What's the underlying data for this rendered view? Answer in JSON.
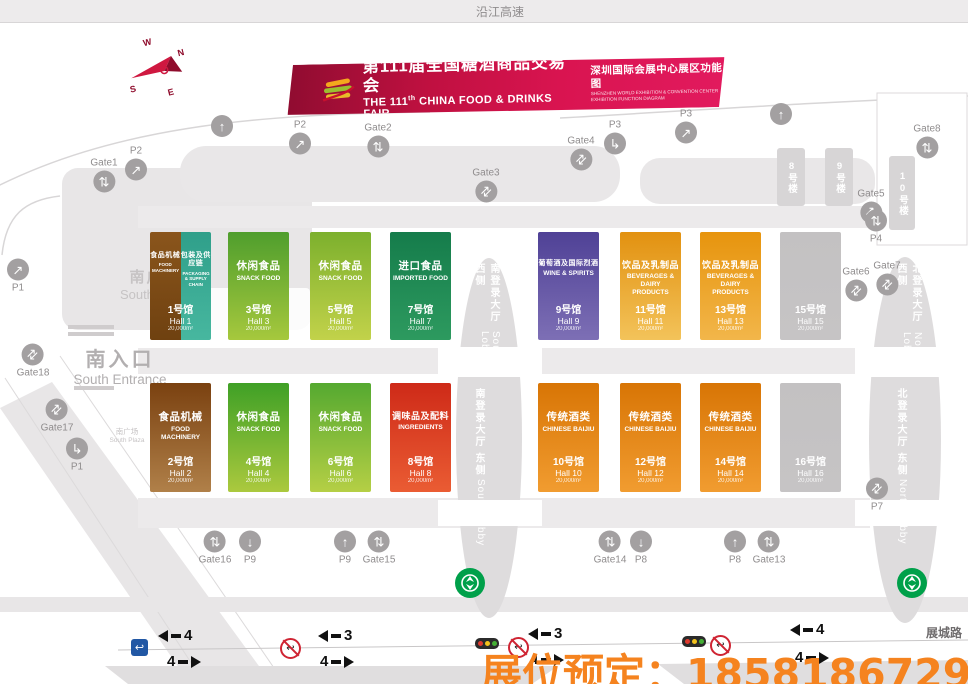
{
  "top_road": {
    "label": "沿江高速"
  },
  "bottom_road": {
    "label": "展城路"
  },
  "compass": {
    "n": "N",
    "e": "E",
    "s": "S",
    "w": "W"
  },
  "banner": {
    "title_zh": "第111届全国糖酒商品交易会",
    "en_pre": "THE 111",
    "en_sup": "th",
    "en_rest": " CHINA FOOD & DRINKS FAIR",
    "sub_zh": "深圳国际会展中心展区功能图",
    "sub_en1": "SHENZHEN WORLD EXHIBITION & CONVENTION CENTER",
    "sub_en2": "EXHIBITION FUNCTION DIAGRAM"
  },
  "places": {
    "south_plaza_zh": "南广场",
    "south_plaza_en": "South Plaza",
    "south_entrance_zh": "南入口",
    "south_entrance_en": "South Entrance",
    "south_plaza_small_zh": "南广场",
    "south_plaza_small_en": "South Plaza"
  },
  "lobbies": [
    {
      "zh": "南登录大厅 西侧",
      "en": "South Lobby",
      "x": 471,
      "y": 263,
      "h": 118
    },
    {
      "zh": "南登录大厅 东侧",
      "en": "South Lobby",
      "x": 471,
      "y": 388,
      "h": 160
    },
    {
      "zh": "北登录大厅 西侧",
      "en": "North Lobby",
      "x": 893,
      "y": 263,
      "h": 118
    },
    {
      "zh": "北登录大厅 东侧",
      "en": "North Lobby",
      "x": 893,
      "y": 388,
      "h": 160
    }
  ],
  "buildings": [
    {
      "label": "8号楼",
      "x": 777,
      "y": 148,
      "w": 28,
      "h": 58
    },
    {
      "label": "9号楼",
      "x": 825,
      "y": 148,
      "w": 28,
      "h": 58
    },
    {
      "label": "10号楼",
      "x": 889,
      "y": 156,
      "w": 26,
      "h": 74
    }
  ],
  "halls_top": [
    {
      "no": "1",
      "split": true,
      "left": {
        "zh": "食品机械",
        "en": "FOOD MACHINERY",
        "g": [
          "#8a551c",
          "#6f4110"
        ]
      },
      "right": {
        "zh": "包装及供应链",
        "en": "PACKAGING & SUPPLY CHAIN",
        "g": [
          "#2f9f8a",
          "#47b79f"
        ]
      },
      "name_zh": "1号馆",
      "name_en": "Hall 1",
      "area": "20,000m²"
    },
    {
      "no": "3",
      "zh": "休闲食品",
      "en": "SNACK FOOD",
      "g": [
        "#4f9e2d",
        "#a6c83d"
      ],
      "name_zh": "3号馆",
      "name_en": "Hall 3",
      "area": "20,000m²"
    },
    {
      "no": "5",
      "zh": "休闲食品",
      "en": "SNACK FOOD",
      "g": [
        "#7cb02d",
        "#c2d24a"
      ],
      "name_zh": "5号馆",
      "name_en": "Hall 5",
      "area": "20,000m²"
    },
    {
      "no": "7",
      "zh": "进口食品",
      "en": "IMPORTED FOOD",
      "g": [
        "#157c4b",
        "#2d9a5f"
      ],
      "name_zh": "7号馆",
      "name_en": "Hall 7",
      "area": "20,000m²"
    },
    {
      "no": "9",
      "zh": "葡萄酒及国际烈酒",
      "en": "WINE & SPIRITS",
      "g": [
        "#4f4196",
        "#7d6fb5"
      ],
      "name_zh": "9号馆",
      "name_en": "Hall 9",
      "area": "20,000m²"
    },
    {
      "no": "11",
      "zh": "饮品及乳制品",
      "en": "BEVERAGES & DAIRY PRODUCTS",
      "g": [
        "#e29110",
        "#f3c35a"
      ],
      "name_zh": "11号馆",
      "name_en": "Hall 11",
      "area": "20,000m²"
    },
    {
      "no": "13",
      "zh": "饮品及乳制品",
      "en": "BEVERAGES & DAIRY PRODUCTS",
      "g": [
        "#e7940d",
        "#f2b64a"
      ],
      "name_zh": "13号馆",
      "name_en": "Hall 13",
      "area": "20,000m²"
    },
    {
      "no": "15",
      "zh": "",
      "en": "",
      "g": [
        "#c3c1c2",
        "#c6c4c5"
      ],
      "name_zh": "15号馆",
      "name_en": "Hall 15",
      "area": "20,000m²"
    }
  ],
  "halls_bottom": [
    {
      "no": "2",
      "zh": "食品机械",
      "en": "FOOD MACHINERY",
      "g": [
        "#7a4110",
        "#b08049"
      ],
      "name_zh": "2号馆",
      "name_en": "Hall 2",
      "area": "20,000m²"
    },
    {
      "no": "4",
      "zh": "休闲食品",
      "en": "SNACK FOOD",
      "g": [
        "#3fa026",
        "#abc93e"
      ],
      "name_zh": "4号馆",
      "name_en": "Hall 4",
      "area": "20,000m²"
    },
    {
      "no": "6",
      "zh": "休闲食品",
      "en": "SNACK FOOD",
      "g": [
        "#55a930",
        "#b5cf45"
      ],
      "name_zh": "6号馆",
      "name_en": "Hall 6",
      "area": "20,000m²"
    },
    {
      "no": "8",
      "zh": "调味品及配料",
      "en": "INGREDIENTS",
      "g": [
        "#ce2a18",
        "#ea5c33"
      ],
      "name_zh": "8号馆",
      "name_en": "Hall 8",
      "area": "20,000m²"
    },
    {
      "no": "10",
      "zh": "传统酒类",
      "en": "CHINESE BAIJIU",
      "g": [
        "#d87505",
        "#f19c30"
      ],
      "name_zh": "10号馆",
      "name_en": "Hall 10",
      "area": "20,000m²"
    },
    {
      "no": "12",
      "zh": "传统酒类",
      "en": "CHINESE BAIJIU",
      "g": [
        "#d87505",
        "#f19c30"
      ],
      "name_zh": "12号馆",
      "name_en": "Hall 12",
      "area": "20,000m²"
    },
    {
      "no": "14",
      "zh": "传统酒类",
      "en": "CHINESE BAIJIU",
      "g": [
        "#d87505",
        "#f19c30"
      ],
      "name_zh": "14号馆",
      "name_en": "Hall 14",
      "area": "20,000m²"
    },
    {
      "no": "16",
      "zh": "",
      "en": "",
      "g": [
        "#c3c1c2",
        "#c6c4c5"
      ],
      "name_zh": "16号馆",
      "name_en": "Hall 16",
      "area": "20,000m²"
    }
  ],
  "markers": [
    {
      "label": "Gate1",
      "x": 104,
      "y": 174,
      "side": "top",
      "g": "updown"
    },
    {
      "label": "P2",
      "x": 136,
      "y": 162,
      "side": "top",
      "g": "diag"
    },
    {
      "label": "P2",
      "x": 300,
      "y": 136,
      "side": "top",
      "g": "diag"
    },
    {
      "label": "Gate2",
      "x": 378,
      "y": 139,
      "side": "top",
      "g": "updown"
    },
    {
      "label": "Gate3",
      "x": 486,
      "y": 184,
      "side": "top",
      "g": "diagdouble"
    },
    {
      "label": "Gate4",
      "x": 581,
      "y": 152,
      "side": "top",
      "g": "diagdouble"
    },
    {
      "label": "P3",
      "x": 615,
      "y": 136,
      "side": "top",
      "g": "corner"
    },
    {
      "label": "P3",
      "x": 686,
      "y": 125,
      "side": "top",
      "g": "diag"
    },
    {
      "label": "",
      "x": 781,
      "y": 114,
      "side": "top",
      "g": "up"
    },
    {
      "label": "",
      "x": 222,
      "y": 126,
      "side": "top",
      "g": "up"
    },
    {
      "label": "Gate8",
      "x": 927,
      "y": 140,
      "side": "top",
      "g": "updown"
    },
    {
      "label": "Gate5",
      "x": 871,
      "y": 205,
      "side": "top",
      "g": "diagdouble"
    },
    {
      "label": "P4",
      "x": 876,
      "y": 228,
      "side": "bottom",
      "g": "updown"
    },
    {
      "label": "Gate6",
      "x": 856,
      "y": 283,
      "side": "top",
      "g": "diagdouble"
    },
    {
      "label": "Gate7",
      "x": 887,
      "y": 277,
      "side": "top",
      "g": "diagdouble"
    },
    {
      "label": "Gate18",
      "x": 33,
      "y": 362,
      "side": "bottom",
      "g": "diagdouble"
    },
    {
      "label": "Gate17",
      "x": 57,
      "y": 417,
      "side": "bottom",
      "g": "diagdouble"
    },
    {
      "label": "P1",
      "x": 18,
      "y": 277,
      "side": "bottom",
      "g": "diag"
    },
    {
      "label": "P1",
      "x": 77,
      "y": 456,
      "side": "bottom",
      "g": "corner"
    },
    {
      "label": "P7",
      "x": 877,
      "y": 496,
      "side": "bottom",
      "g": "diagdouble"
    },
    {
      "label": "Gate16",
      "x": 215,
      "y": 549,
      "side": "bottom",
      "g": "updown"
    },
    {
      "label": "P9",
      "x": 250,
      "y": 549,
      "side": "bottom",
      "g": "down"
    },
    {
      "label": "P9",
      "x": 345,
      "y": 549,
      "side": "bottom",
      "g": "up"
    },
    {
      "label": "Gate15",
      "x": 379,
      "y": 549,
      "side": "bottom",
      "g": "updown"
    },
    {
      "label": "Gate14",
      "x": 610,
      "y": 549,
      "side": "bottom",
      "g": "updown"
    },
    {
      "label": "P8",
      "x": 641,
      "y": 549,
      "side": "bottom",
      "g": "down"
    },
    {
      "label": "P8",
      "x": 735,
      "y": 549,
      "side": "bottom",
      "g": "up"
    },
    {
      "label": "Gate13",
      "x": 769,
      "y": 549,
      "side": "bottom",
      "g": "updown"
    }
  ],
  "traffic": {
    "lanes": [
      {
        "x": 158,
        "y": 627,
        "dir": "left",
        "n": "4"
      },
      {
        "x": 167,
        "y": 653,
        "dir": "right",
        "n": "4"
      },
      {
        "x": 318,
        "y": 627,
        "dir": "left",
        "n": "3"
      },
      {
        "x": 320,
        "y": 653,
        "dir": "right",
        "n": "4"
      },
      {
        "x": 528,
        "y": 625,
        "dir": "left",
        "n": "3"
      },
      {
        "x": 530,
        "y": 651,
        "dir": "right",
        "n": "4"
      },
      {
        "x": 790,
        "y": 621,
        "dir": "left",
        "n": "4"
      },
      {
        "x": 795,
        "y": 649,
        "dir": "right",
        "n": "4"
      }
    ],
    "signs": [
      {
        "t": "uturn",
        "x": 131,
        "y": 639
      },
      {
        "t": "nouturn",
        "x": 280,
        "y": 638
      },
      {
        "t": "light",
        "x": 475,
        "y": 638
      },
      {
        "t": "nouturn",
        "x": 508,
        "y": 637
      },
      {
        "t": "light",
        "x": 682,
        "y": 636
      },
      {
        "t": "nouturn",
        "x": 710,
        "y": 635
      }
    ]
  },
  "metro": {
    "color": "#00a04a",
    "positions": [
      {
        "x": 455,
        "y": 568
      },
      {
        "x": 897,
        "y": 568
      }
    ]
  },
  "overlay": {
    "label": "展位预定：",
    "phone": "18581867296",
    "color": "#f5831f"
  }
}
